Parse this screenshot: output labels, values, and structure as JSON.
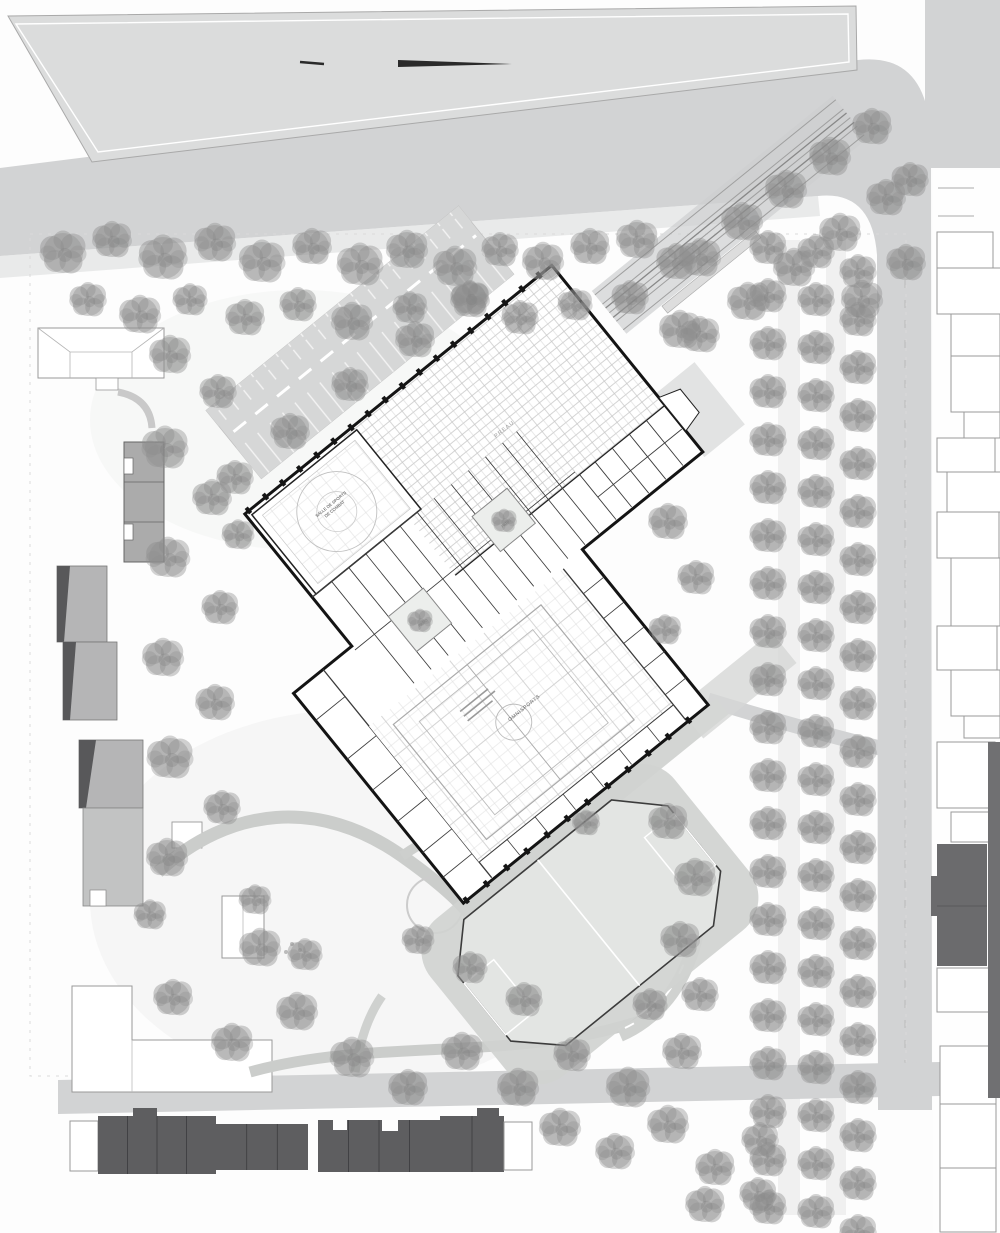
{
  "drawing": {
    "kind": "architectural site plan",
    "building_labels": {
      "preau_label": "PREAU",
      "combat_hall_line1": "SALLE DE SPORTS",
      "combat_hall_line2": "DE COMBAT",
      "gym_label": "OMNISPORTS",
      "patio1_label": "PATIO",
      "patio2_label": "PATIO"
    }
  },
  "colors": {
    "road": "#d2d3d4",
    "top_parcel": "#dbdcdc",
    "building_wall": "#141414",
    "existing_building_gray": "#b5b5b6",
    "existing_building_shadow": "#58585a",
    "terraced_house_dark": "#5e5e60",
    "tree_gray": "#8f8f8f",
    "field_fill": "#e3e5e3",
    "field_walk": "#d0d2d0",
    "grid_line": "#c9c9c9"
  },
  "trees": {
    "scattered": [
      [
        63,
        253,
        1
      ],
      [
        112,
        240,
        0.85
      ],
      [
        163,
        258,
        1.05
      ],
      [
        215,
        243,
        0.9
      ],
      [
        262,
        262,
        1
      ],
      [
        312,
        247,
        0.85
      ],
      [
        360,
        265,
        1
      ],
      [
        407,
        250,
        0.9
      ],
      [
        455,
        267,
        0.95
      ],
      [
        500,
        250,
        0.8
      ],
      [
        543,
        262,
        0.9
      ],
      [
        590,
        247,
        0.85
      ],
      [
        637,
        240,
        0.9
      ],
      [
        676,
        262,
        0.85
      ],
      [
        88,
        300,
        0.8
      ],
      [
        140,
        315,
        0.9
      ],
      [
        190,
        300,
        0.75
      ],
      [
        245,
        318,
        0.85
      ],
      [
        298,
        305,
        0.8
      ],
      [
        352,
        322,
        0.9
      ],
      [
        410,
        308,
        0.75
      ],
      [
        470,
        300,
        0.85
      ],
      [
        520,
        318,
        0.8
      ],
      [
        575,
        305,
        0.75
      ],
      [
        630,
        298,
        0.8
      ],
      [
        680,
        330,
        0.9
      ],
      [
        700,
        258,
        0.9
      ],
      [
        742,
        222,
        0.9
      ],
      [
        786,
        190,
        0.9
      ],
      [
        830,
        157,
        0.9
      ],
      [
        872,
        127,
        0.85
      ],
      [
        748,
        302,
        0.9
      ],
      [
        794,
        268,
        0.9
      ],
      [
        840,
        233,
        0.9
      ],
      [
        886,
        198,
        0.85
      ],
      [
        700,
        335,
        0.85
      ],
      [
        862,
        300,
        0.9
      ],
      [
        906,
        263,
        0.85
      ],
      [
        910,
        180,
        0.8
      ],
      [
        170,
        355,
        0.9
      ],
      [
        218,
        392,
        0.8
      ],
      [
        165,
        448,
        1
      ],
      [
        212,
        498,
        0.85
      ],
      [
        168,
        558,
        0.95
      ],
      [
        220,
        608,
        0.8
      ],
      [
        163,
        658,
        0.9
      ],
      [
        215,
        703,
        0.85
      ],
      [
        170,
        758,
        1
      ],
      [
        222,
        808,
        0.8
      ],
      [
        167,
        858,
        0.9
      ],
      [
        150,
        915,
        0.7
      ],
      [
        260,
        948,
        0.9
      ],
      [
        173,
        998,
        0.85
      ],
      [
        232,
        1043,
        0.9
      ],
      [
        235,
        478,
        0.8
      ],
      [
        290,
        432,
        0.85
      ],
      [
        350,
        385,
        0.8
      ],
      [
        415,
        340,
        0.85
      ],
      [
        470,
        298,
        0.8
      ],
      [
        238,
        535,
        0.7
      ],
      [
        255,
        900,
        0.7
      ],
      [
        305,
        955,
        0.75
      ],
      [
        297,
        1012,
        0.9
      ],
      [
        352,
        1058,
        0.95
      ],
      [
        408,
        1088,
        0.85
      ],
      [
        462,
        1052,
        0.9
      ],
      [
        518,
        1088,
        0.9
      ],
      [
        572,
        1055,
        0.8
      ],
      [
        628,
        1088,
        0.95
      ],
      [
        682,
        1052,
        0.85
      ],
      [
        524,
        1000,
        0.8
      ],
      [
        470,
        968,
        0.75
      ],
      [
        418,
        940,
        0.7
      ],
      [
        560,
        1128,
        0.9
      ],
      [
        615,
        1152,
        0.85
      ],
      [
        668,
        1125,
        0.9
      ],
      [
        715,
        1168,
        0.85
      ],
      [
        760,
        1140,
        0.8
      ],
      [
        705,
        1205,
        0.85
      ],
      [
        758,
        1195,
        0.8
      ],
      [
        668,
        822,
        0.85
      ],
      [
        695,
        878,
        0.9
      ],
      [
        680,
        940,
        0.85
      ],
      [
        700,
        995,
        0.8
      ],
      [
        650,
        1005,
        0.75
      ],
      [
        668,
        522,
        0.85
      ],
      [
        696,
        578,
        0.8
      ],
      [
        665,
        630,
        0.7
      ],
      [
        504,
        521,
        0.55
      ],
      [
        420,
        621,
        0.55
      ],
      [
        586,
        823,
        0.6
      ]
    ],
    "allee_grid": {
      "cols": [
        {
          "x": 768,
          "y0": 248
        },
        {
          "x": 816,
          "y0": 252
        },
        {
          "x": 858,
          "y0": 272
        }
      ],
      "step": 48,
      "count": 21,
      "scale": 0.8
    }
  },
  "right_houses": [
    [
      937,
      232,
      56,
      36
    ],
    [
      937,
      268,
      66,
      46
    ],
    [
      951,
      314,
      49,
      42
    ],
    [
      951,
      356,
      49,
      56
    ],
    [
      964,
      412,
      36,
      26
    ],
    [
      937,
      438,
      58,
      34
    ],
    [
      947,
      472,
      54,
      40
    ],
    [
      937,
      512,
      62,
      46
    ],
    [
      951,
      558,
      49,
      68
    ],
    [
      937,
      626,
      60,
      44
    ],
    [
      951,
      670,
      49,
      46
    ],
    [
      964,
      716,
      36,
      22
    ],
    [
      937,
      742,
      58,
      66
    ],
    [
      951,
      812,
      49,
      30
    ],
    [
      937,
      968,
      52,
      44
    ],
    [
      940,
      1046,
      56,
      58
    ],
    [
      940,
      1104,
      56,
      64
    ],
    [
      940,
      1168,
      56,
      64
    ]
  ],
  "bottom_houses": {
    "groups": [
      {
        "x": 98,
        "y": 1116,
        "w": 118,
        "h": 58,
        "units": 4
      },
      {
        "x": 216,
        "y": 1124,
        "w": 92,
        "h": 46,
        "units": 3
      },
      {
        "x": 318,
        "y": 1120,
        "w": 122,
        "h": 52,
        "units": 4
      },
      {
        "x": 440,
        "y": 1116,
        "w": 64,
        "h": 56,
        "units": 2
      }
    ]
  }
}
